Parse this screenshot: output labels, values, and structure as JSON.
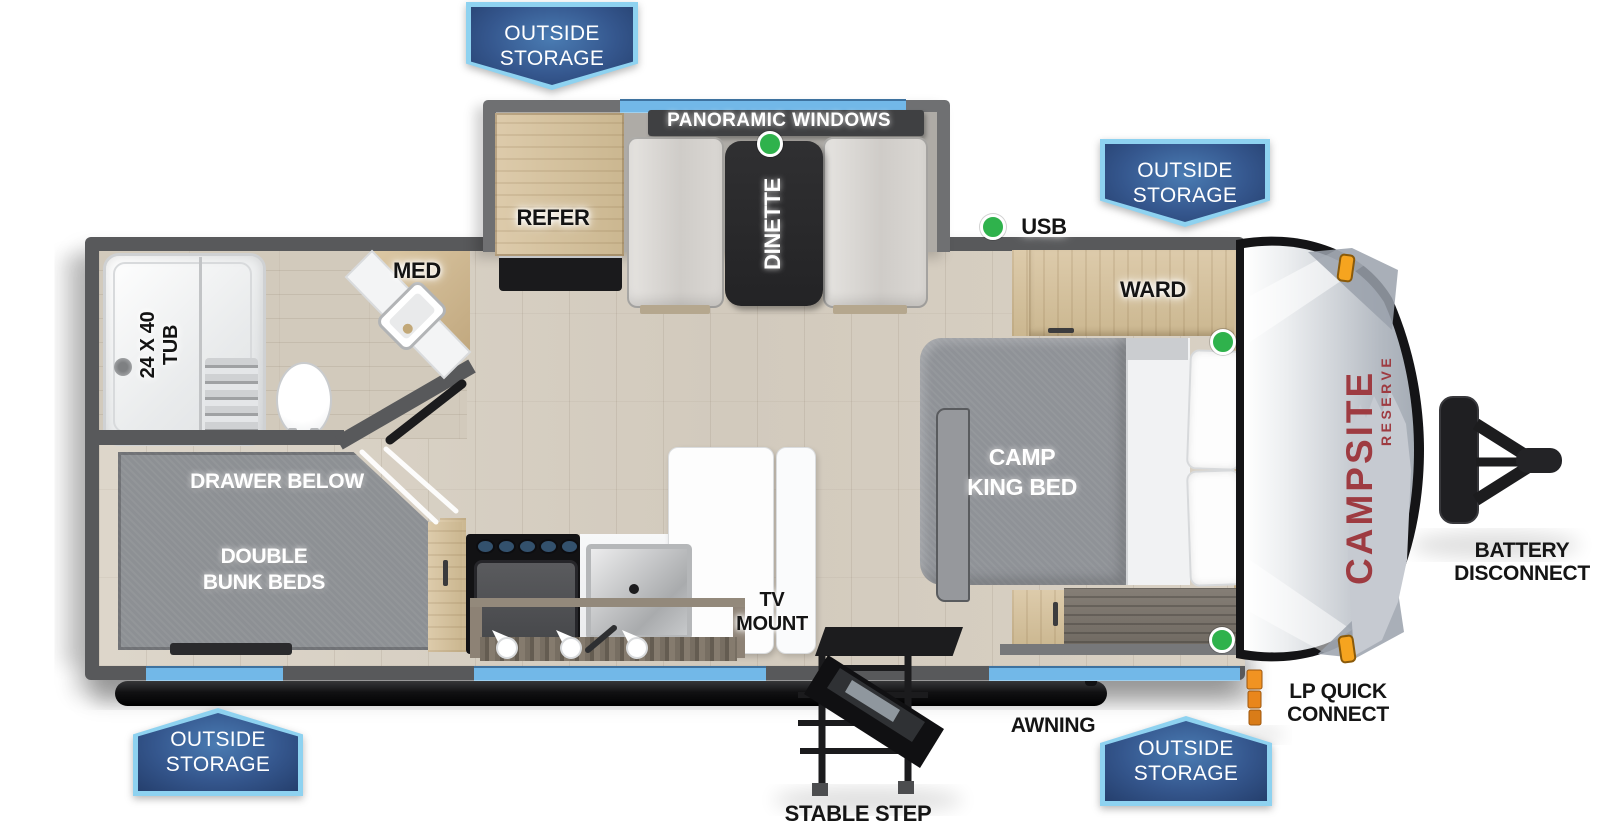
{
  "page": {
    "description": "Travel trailer RV floor plan, top view"
  },
  "brand": {
    "name": "CAMPSITE",
    "series": "RESERVE"
  },
  "storage_badges": {
    "line1": "OUTSIDE",
    "line2": "STORAGE"
  },
  "labels": {
    "panoramic_windows": "PANORAMIC WINDOWS",
    "dinette": "DINETTE",
    "refer": "REFER",
    "usb": "USB",
    "med": "MED",
    "ward": "WARD",
    "tub_line1": "24 X 40",
    "tub_line2": "TUB",
    "camp_king_line1": "CAMP",
    "camp_king_line2": "KING BED",
    "drawer_below": "DRAWER BELOW",
    "bunk_line1": "DOUBLE",
    "bunk_line2": "BUNK BEDS",
    "tv_line1": "TV",
    "tv_line2": "MOUNT"
  },
  "callouts": {
    "battery_line1": "BATTERY",
    "battery_line2": "DISCONNECT",
    "lp_line1": "LP QUICK",
    "lp_line2": "CONNECT",
    "awning": "AWNING",
    "stable_step": "STABLE STEP"
  },
  "indicators": {
    "green_dot_count": 4
  },
  "colors": {
    "window_blue": "#72b8e8",
    "badge_border": "#8ed2f0",
    "badge_fill": "#253f6d",
    "indicator_green": "#2fb24c",
    "clearance_amber": "#f6a41f",
    "lp_orange": "#e9861c",
    "brand_red": "#9e3b41",
    "wall_gray": "#58595b"
  }
}
